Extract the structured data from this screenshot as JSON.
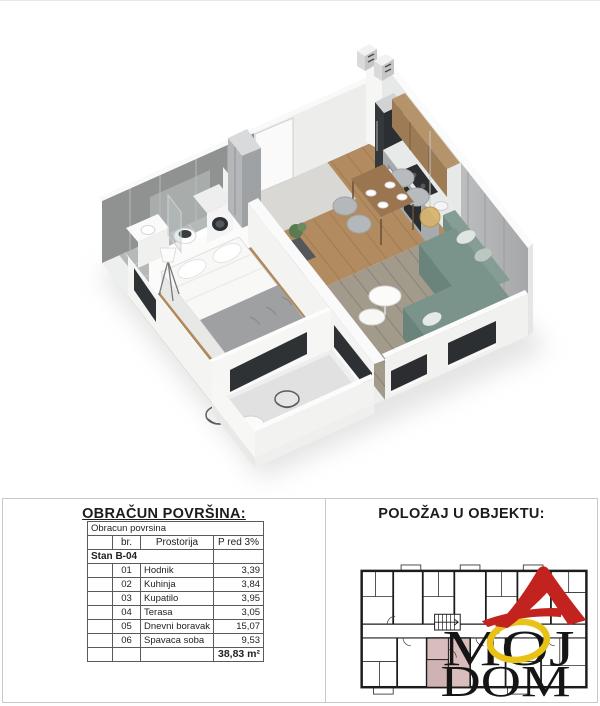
{
  "area_panel": {
    "title": "OBRAČUN POVRŠINA:",
    "table": {
      "caption": "Obracun povrsina",
      "col_br": "br.",
      "col_room": "Prostorija",
      "col_area": "P red 3%",
      "group": "Stan B-04",
      "rows": [
        {
          "br": "01",
          "room": "Hodnik",
          "area": "3,39"
        },
        {
          "br": "02",
          "room": "Kuhinja",
          "area": "3,84"
        },
        {
          "br": "03",
          "room": "Kupatilo",
          "area": "3,95"
        },
        {
          "br": "04",
          "room": "Terasa",
          "area": "3,05"
        },
        {
          "br": "05",
          "room": "Dnevni boravak",
          "area": "15,07"
        },
        {
          "br": "06",
          "room": "Spavaca soba",
          "area": "9,53"
        }
      ],
      "total": "38,83 m²"
    }
  },
  "position_panel": {
    "title": "POLOŽAJ U OBJEKTU:",
    "logo": {
      "line1": "MOJ",
      "line2": "DOM"
    }
  },
  "colors": {
    "logo_red": "#c3231f",
    "logo_yellow": "#e8c217",
    "unit_highlight": "#d9bcbc",
    "plan_line": "#1c1c1c",
    "sofa_teal": "#7a948b",
    "wood_floor": "#b28c60",
    "wall_gray": "#b3b4b6"
  }
}
